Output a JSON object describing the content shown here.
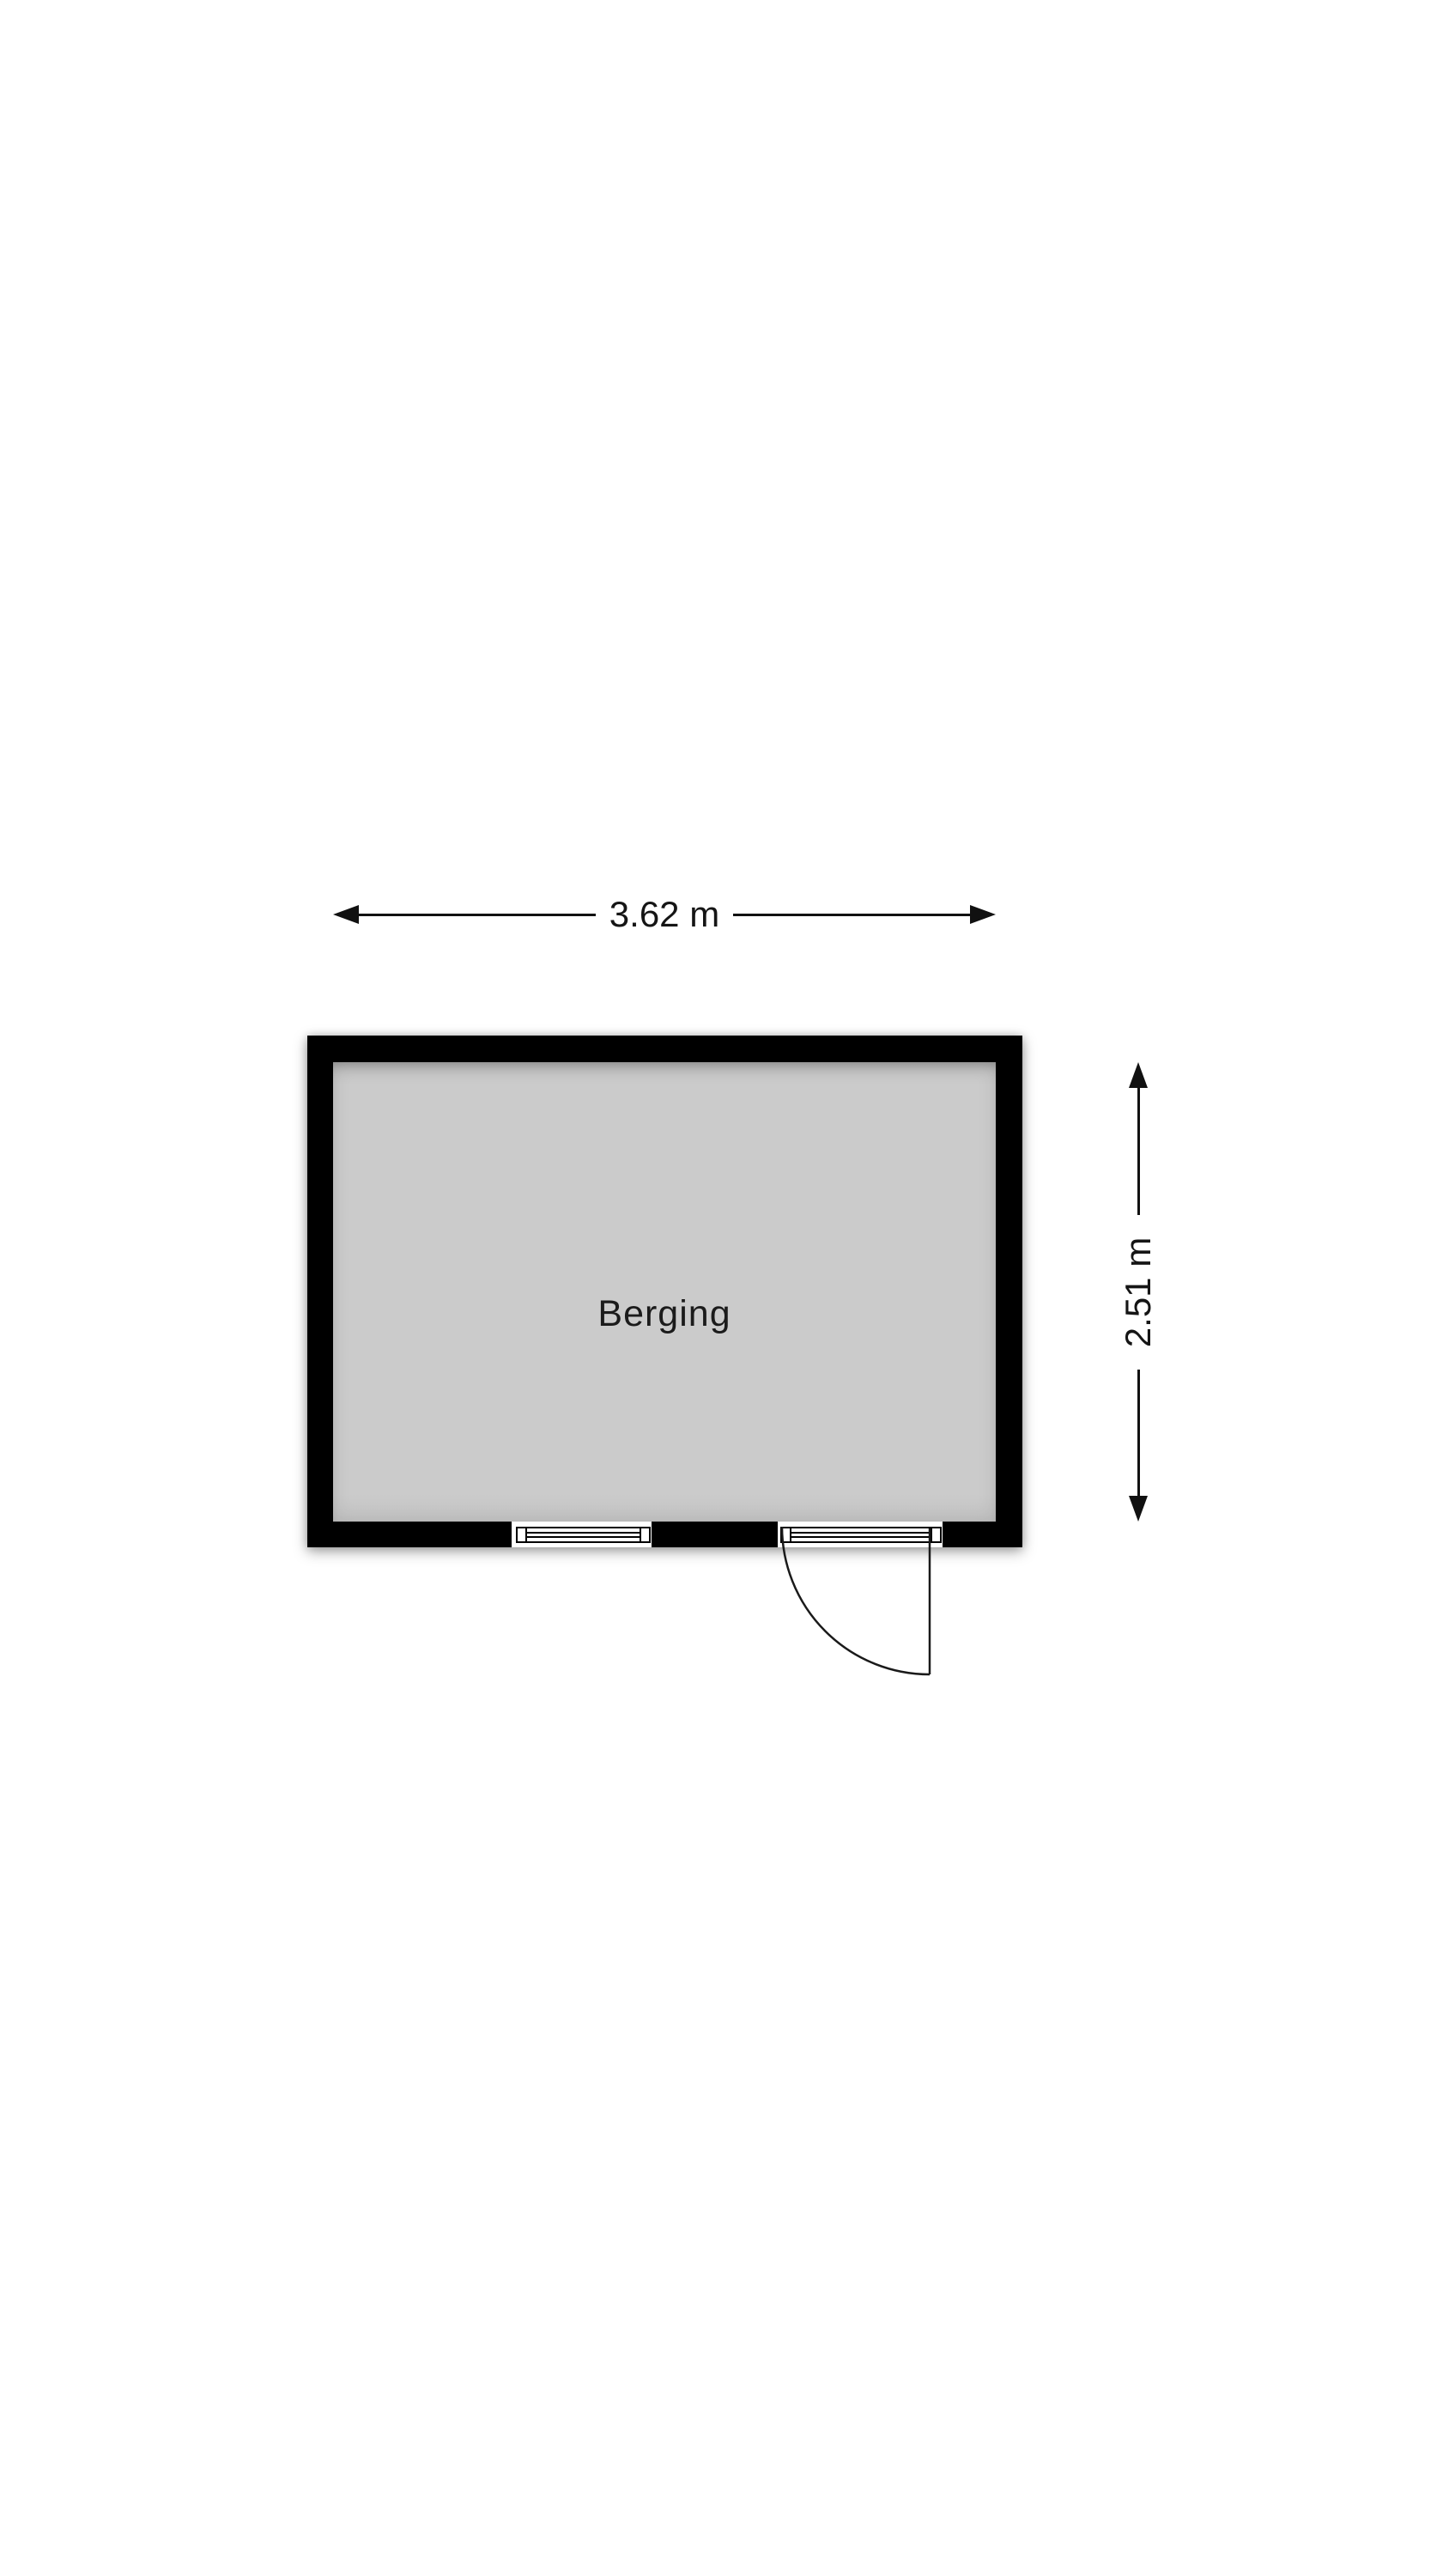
{
  "room": {
    "label": "Berging"
  },
  "dimensions": {
    "width_label": "3.62 m",
    "height_label": "2.51 m"
  },
  "colors": {
    "wall": "#000000",
    "floor": "#cbcbcb",
    "line": "#111111",
    "text": "#151515",
    "background": "#ffffff"
  },
  "icons": {
    "arrow_left": "triangle-left",
    "arrow_right": "triangle-right",
    "arrow_up": "triangle-up",
    "arrow_down": "triangle-down",
    "window": "double-pane-window-bar",
    "door": "quarter-circle-door-swing"
  }
}
